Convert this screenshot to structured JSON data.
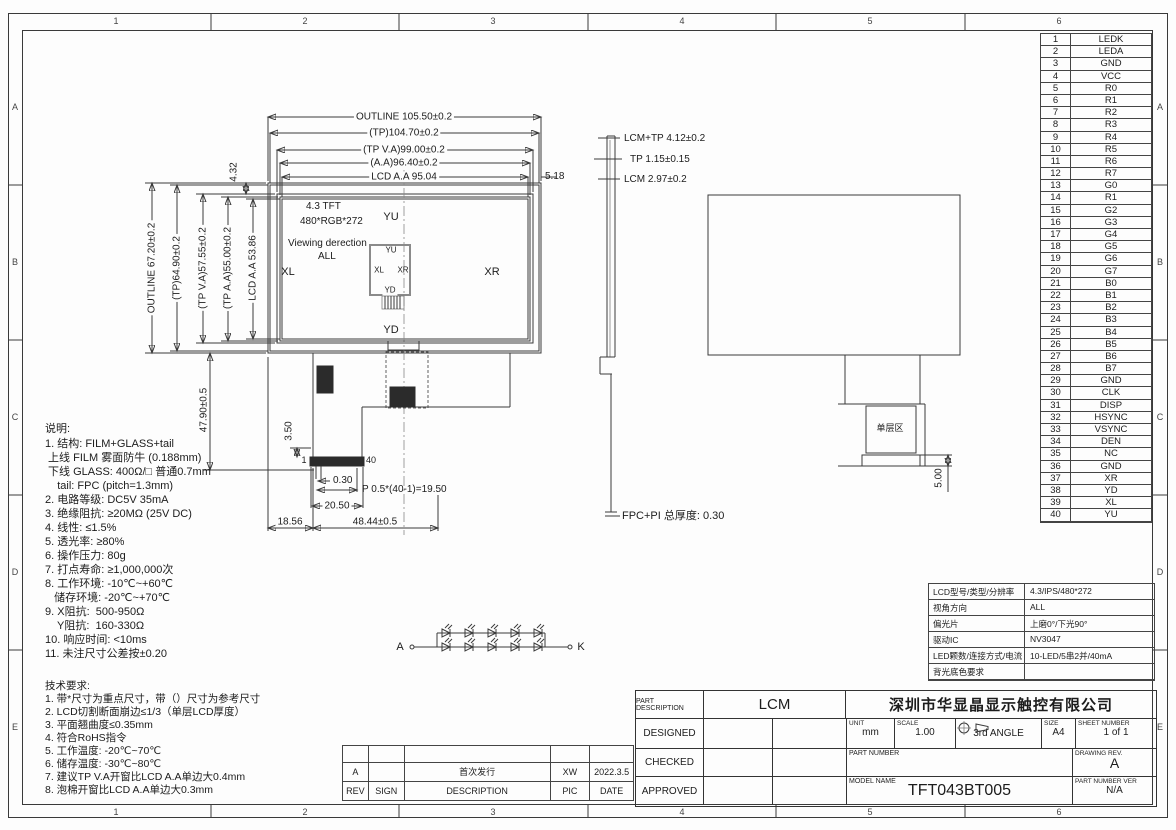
{
  "zones": {
    "cols": [
      "1",
      "2",
      "3",
      "4",
      "5",
      "6"
    ],
    "rows": [
      "A",
      "B",
      "C",
      "D",
      "E"
    ]
  },
  "front_view": {
    "dim_outline_w": "OUTLINE 105.50±0.2",
    "dim_tp_w": "(TP)104.70±0.2",
    "dim_tpva_w": "(TP V.A)99.00±0.2",
    "dim_aa_w": "(A.A)96.40±0.2",
    "dim_lcdaa_w": "LCD A.A 95.04",
    "dim_right_gap": "5.18",
    "dim_outline_h": "OUTLINE 67.20±0.2",
    "dim_tp_h": "(TP)64.90±0.2",
    "dim_tpva_h": "(TP V.A)57.55±0.2",
    "dim_tpaa_h": "(TP A.A)55.00±0.2",
    "dim_lcdaa_h": "LCD A.A 53.86",
    "dim_top_gap": "4.32",
    "panel_line1": "4.3 TFT",
    "panel_line2": "480*RGB*272",
    "viewing_line1": "Viewing derection",
    "viewing_line2": "ALL",
    "label_yu": "YU",
    "label_xl": "XL",
    "label_xr": "XR",
    "label_yd": "YD",
    "inner_yu": "YU",
    "inner_xl": "XL",
    "inner_xr": "XR",
    "inner_yd": "YD",
    "pin_first": "1",
    "pin_last": "40",
    "dim_tail_h": "47.90±0.5",
    "dim_350": "3.50",
    "dim_030": "0.30",
    "dim_pitch": "P 0.5*(40-1)=19.50",
    "dim_2050": "20.50",
    "dim_1856": "18.56",
    "dim_4844": "48.44±0.5"
  },
  "side_view": {
    "dim1": "LCM+TP 4.12±0.2",
    "dim2": "TP 1.15±0.15",
    "dim3": "LCM 2.97±0.2",
    "fpc_note": "FPC+PI 总厚度: 0.30"
  },
  "rear_view": {
    "hatch_label": "单层区",
    "dim_500": "5.00"
  },
  "led_circuit": {
    "anode": "A",
    "cathode": "K"
  },
  "notes": {
    "title": "说明:",
    "lines": [
      "1. 结构: FILM+GLASS+tail",
      " 上线 FILM 雾面防牛 (0.188mm)",
      " 下线 GLASS: 400Ω/□ 普通0.7mm",
      "    tail: FPC (pitch=1.3mm)",
      "2. 电路等级: DC5V 35mA",
      "3. 绝缘阻抗: ≥20MΩ (25V DC)",
      "4. 线性: ≤1.5%",
      "5. 透光率: ≥80%",
      "6. 操作压力: 80g",
      "7. 打点寿命: ≥1,000,000次",
      "8. 工作环境: -10℃~+60℃",
      "   储存环境: -20℃~+70℃",
      "9. X阻抗:  500-950Ω",
      "    Y阻抗:  160-330Ω",
      "10. 响应时间: <10ms",
      "11. 未注尺寸公差按±0.20"
    ]
  },
  "tech_req": {
    "title": "技术要求:",
    "lines": [
      "1. 带*尺寸为重点尺寸，带（）尺寸为参考尺寸",
      "2. LCD切割断面崩边≤1/3（单层LCD厚度）",
      "3. 平面翘曲度≤0.35mm",
      "4. 符合RoHS指令",
      "5. 工作温度: -20℃~70℃",
      "6. 储存温度: -30℃~80℃",
      "7. 建议TP V.A开窗比LCD A.A单边大0.4mm",
      "8. 泡棉开窗比LCD A.A单边大0.3mm"
    ]
  },
  "pin_table": {
    "rows": [
      {
        "no": "1",
        "name": "LEDK"
      },
      {
        "no": "2",
        "name": "LEDA"
      },
      {
        "no": "3",
        "name": "GND"
      },
      {
        "no": "4",
        "name": "VCC"
      },
      {
        "no": "5",
        "name": "R0"
      },
      {
        "no": "6",
        "name": "R1"
      },
      {
        "no": "7",
        "name": "R2"
      },
      {
        "no": "8",
        "name": "R3"
      },
      {
        "no": "9",
        "name": "R4"
      },
      {
        "no": "10",
        "name": "R5"
      },
      {
        "no": "11",
        "name": "R6"
      },
      {
        "no": "12",
        "name": "R7"
      },
      {
        "no": "13",
        "name": "G0"
      },
      {
        "no": "14",
        "name": "R1"
      },
      {
        "no": "15",
        "name": "G2"
      },
      {
        "no": "16",
        "name": "G3"
      },
      {
        "no": "17",
        "name": "G4"
      },
      {
        "no": "18",
        "name": "G5"
      },
      {
        "no": "19",
        "name": "G6"
      },
      {
        "no": "20",
        "name": "G7"
      },
      {
        "no": "21",
        "name": "B0"
      },
      {
        "no": "22",
        "name": "B1"
      },
      {
        "no": "23",
        "name": "B2"
      },
      {
        "no": "24",
        "name": "B3"
      },
      {
        "no": "25",
        "name": "B4"
      },
      {
        "no": "26",
        "name": "B5"
      },
      {
        "no": "27",
        "name": "B6"
      },
      {
        "no": "28",
        "name": "B7"
      },
      {
        "no": "29",
        "name": "GND"
      },
      {
        "no": "30",
        "name": "CLK"
      },
      {
        "no": "31",
        "name": "DISP"
      },
      {
        "no": "32",
        "name": "HSYNC"
      },
      {
        "no": "33",
        "name": "VSYNC"
      },
      {
        "no": "34",
        "name": "DEN"
      },
      {
        "no": "35",
        "name": "NC"
      },
      {
        "no": "36",
        "name": "GND"
      },
      {
        "no": "37",
        "name": "XR"
      },
      {
        "no": "38",
        "name": "YD"
      },
      {
        "no": "39",
        "name": "XL"
      },
      {
        "no": "40",
        "name": "YU"
      }
    ]
  },
  "spec_table": {
    "rows": [
      {
        "label": "LCD型号/类型/分辨率",
        "value": "4.3/IPS/480*272"
      },
      {
        "label": "视角方向",
        "value": "ALL"
      },
      {
        "label": "偏光片",
        "value": "上磨0°/下光90°"
      },
      {
        "label": "驱动IC",
        "value": "NV3047"
      },
      {
        "label": "LED颗数/连接方式/电流",
        "value": "10-LED/5串2并/40mA"
      },
      {
        "label": "背光底色要求",
        "value": ""
      }
    ]
  },
  "rev_table": {
    "data_row": {
      "rev": "A",
      "sign": "",
      "desc": "首次发行",
      "pic": "XW",
      "date": "2022.3.5"
    },
    "header_row": {
      "rev": "REV",
      "sign": "SIGN",
      "desc": "DESCRIPTION",
      "pic": "PIC",
      "date": "DATE"
    }
  },
  "title_block": {
    "part_description_label": "PART DESCRIPTION",
    "part_description_value": "LCM",
    "company": "深圳市华显晶显示触控有限公司",
    "designed_label": "DESIGNED",
    "checked_label": "CHECKED",
    "approved_label": "APPROVED",
    "unit_label": "UNIT",
    "unit_value": "mm",
    "scale_label": "SCALE",
    "scale_value": "1.00",
    "angle_label": "3rd ANGLE",
    "size_label": "SIZE",
    "size_value": "A4",
    "sheet_label": "SHEET NUMBER",
    "sheet_value": "1 of 1",
    "part_number_label": "PART NUMBER",
    "drawing_rev_label": "DRAWING REV.",
    "drawing_rev_value": "A",
    "model_name_label": "MODEL NAME",
    "model_name_value": "TFT043BT005",
    "part_ver_label": "PART NUMBER VER",
    "part_ver_value": "N/A"
  }
}
